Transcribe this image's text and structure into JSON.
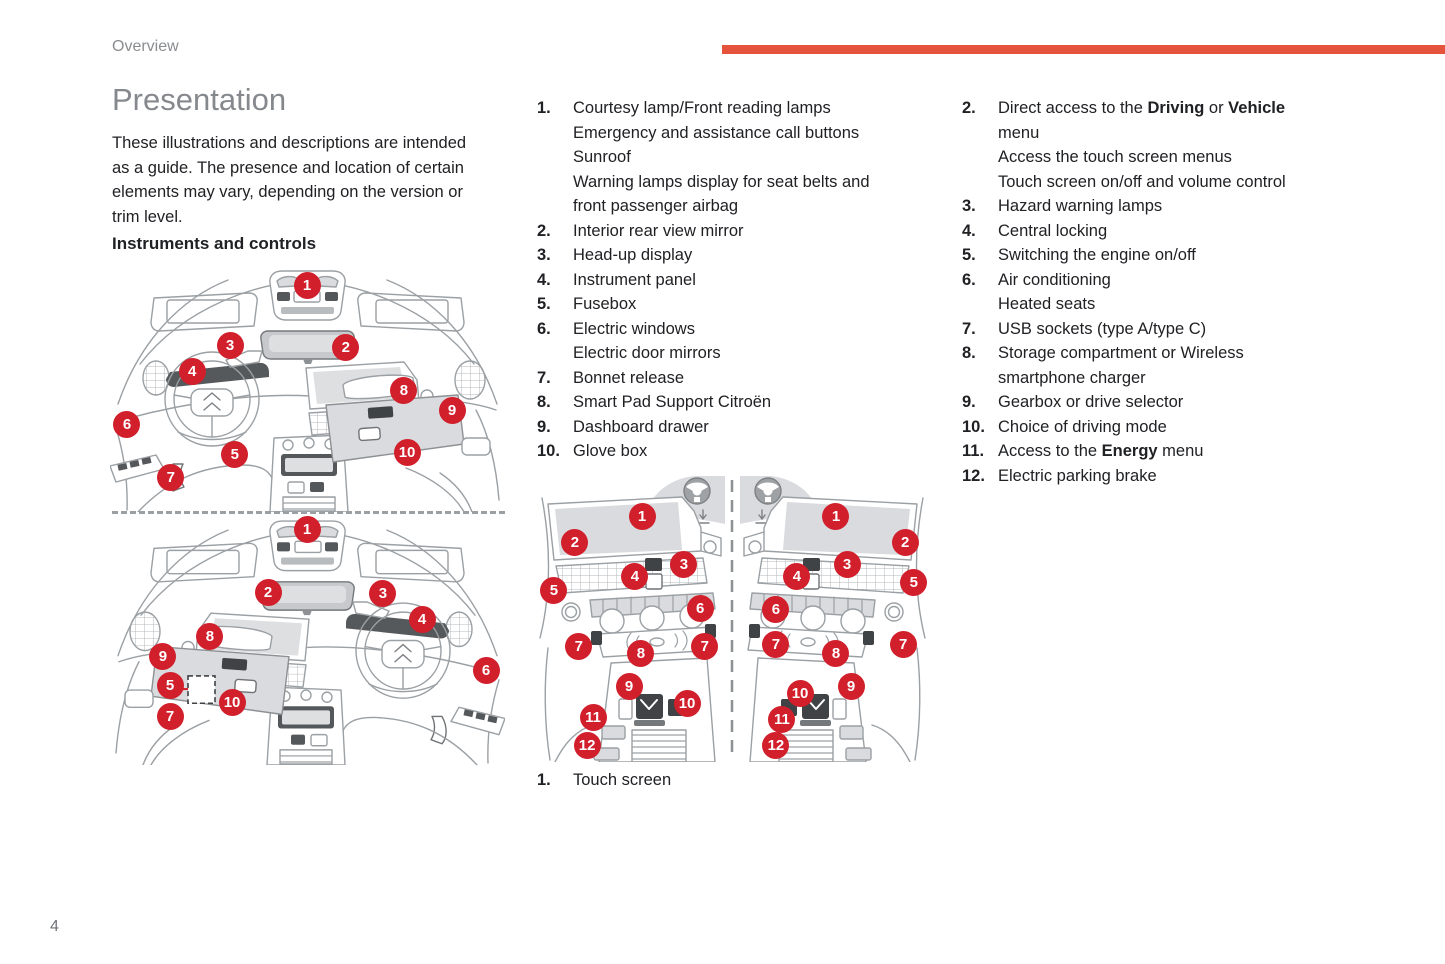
{
  "page": {
    "header": "Overview",
    "page_number": "4",
    "colors": {
      "accent_red": "#e6533c",
      "marker_red": "#d11f2b"
    }
  },
  "intro": {
    "title": "Presentation",
    "body_lines": [
      "These illustrations and descriptions are intended",
      "as a guide. The presence and location of certain",
      "elements may vary, depending on the version or",
      "trim level."
    ],
    "subheading": "Instruments and controls"
  },
  "lists": {
    "instruments": [
      {
        "n": "1.",
        "lines": [
          "Courtesy lamp/Front reading lamps",
          "Emergency and assistance call buttons",
          "Sunroof",
          "Warning lamps display for seat belts and",
          "front passenger airbag"
        ]
      },
      {
        "n": "2.",
        "lines": [
          "Interior rear view mirror"
        ]
      },
      {
        "n": "3.",
        "lines": [
          "Head-up display"
        ]
      },
      {
        "n": "4.",
        "lines": [
          "Instrument panel"
        ]
      },
      {
        "n": "5.",
        "lines": [
          "Fusebox"
        ]
      },
      {
        "n": "6.",
        "lines": [
          "Electric windows",
          "Electric door mirrors"
        ]
      },
      {
        "n": "7.",
        "lines": [
          "Bonnet release"
        ]
      },
      {
        "n": "8.",
        "lines": [
          "Smart Pad Support Citroën"
        ]
      },
      {
        "n": "9.",
        "lines": [
          "Dashboard drawer"
        ]
      },
      {
        "n": "10.",
        "lines": [
          "Glove box"
        ]
      }
    ],
    "console": [
      {
        "n": "2.",
        "lines": [
          [
            {
              "t": "Direct access to the "
            },
            {
              "t": "Driving",
              "b": true
            },
            {
              "t": " or "
            },
            {
              "t": "Vehicle",
              "b": true
            }
          ],
          "menu",
          "Access the touch screen menus",
          "Touch screen on/off and volume control"
        ]
      },
      {
        "n": "3.",
        "lines": [
          "Hazard warning lamps"
        ]
      },
      {
        "n": "4.",
        "lines": [
          "Central locking"
        ]
      },
      {
        "n": "5.",
        "lines": [
          "Switching the engine on/off"
        ]
      },
      {
        "n": "6.",
        "lines": [
          "Air conditioning",
          "Heated seats"
        ]
      },
      {
        "n": "7.",
        "lines": [
          "USB sockets (type A/type C)"
        ]
      },
      {
        "n": "8.",
        "lines": [
          "Storage compartment or Wireless",
          "smartphone charger"
        ]
      },
      {
        "n": "9.",
        "lines": [
          "Gearbox or drive selector"
        ]
      },
      {
        "n": "10.",
        "lines": [
          "Choice of driving mode"
        ]
      },
      {
        "n": "11.",
        "lines": [
          [
            {
              "t": "Access to the "
            },
            {
              "t": "Energy",
              "b": true
            },
            {
              "t": " menu"
            }
          ]
        ]
      },
      {
        "n": "12.",
        "lines": [
          "Electric parking brake"
        ]
      }
    ],
    "console_caption": [
      {
        "n": "1.",
        "lines": [
          "Touch screen"
        ]
      }
    ]
  },
  "diagrams": {
    "dashboard_lhd": {
      "markers": [
        {
          "n": "1",
          "x": 49.9,
          "y": 7.0
        },
        {
          "n": "2",
          "x": 59.7,
          "y": 32.4
        },
        {
          "n": "3",
          "x": 30.4,
          "y": 31.6
        },
        {
          "n": "4",
          "x": 20.8,
          "y": 42.6
        },
        {
          "n": "5",
          "x": 31.6,
          "y": 76.6
        },
        {
          "n": "6",
          "x": 4.3,
          "y": 64.3
        },
        {
          "n": "7",
          "x": 15.4,
          "y": 85.7
        },
        {
          "n": "8",
          "x": 74.4,
          "y": 50.0
        },
        {
          "n": "9",
          "x": 86.6,
          "y": 58.2
        },
        {
          "n": "10",
          "x": 75.2,
          "y": 75.8
        }
      ]
    },
    "dashboard_rhd": {
      "markers": [
        {
          "n": "1",
          "x": 49.9,
          "y": 4.5
        },
        {
          "n": "2",
          "x": 40.0,
          "y": 30.0
        },
        {
          "n": "3",
          "x": 69.1,
          "y": 30.4
        },
        {
          "n": "4",
          "x": 79.0,
          "y": 40.9
        },
        {
          "n": "5",
          "x": 15.2,
          "y": 68.0
        },
        {
          "n": "6",
          "x": 95.2,
          "y": 61.9
        },
        {
          "n": "7",
          "x": 15.2,
          "y": 80.2
        },
        {
          "n": "8",
          "x": 25.3,
          "y": 47.8
        },
        {
          "n": "9",
          "x": 13.4,
          "y": 55.9
        },
        {
          "n": "10",
          "x": 30.9,
          "y": 74.5
        }
      ]
    },
    "console": {
      "markers": [
        {
          "n": "1",
          "x": 27.1,
          "y": 15.8
        },
        {
          "n": "2",
          "x": 10.1,
          "y": 24.7
        },
        {
          "n": "3",
          "x": 37.7,
          "y": 32.2
        },
        {
          "n": "4",
          "x": 25.3,
          "y": 36.6
        },
        {
          "n": "5",
          "x": 4.8,
          "y": 41.1
        },
        {
          "n": "6",
          "x": 41.8,
          "y": 47.6
        },
        {
          "n": "7",
          "x": 11.1,
          "y": 60.6
        },
        {
          "n": "7",
          "x": 43.0,
          "y": 60.6
        },
        {
          "n": "8",
          "x": 26.8,
          "y": 62.7
        },
        {
          "n": "9",
          "x": 23.8,
          "y": 74.0
        },
        {
          "n": "10",
          "x": 38.5,
          "y": 80.1
        },
        {
          "n": "11",
          "x": 14.7,
          "y": 84.6
        },
        {
          "n": "12",
          "x": 13.2,
          "y": 94.2
        },
        {
          "n": "1",
          "x": 76.2,
          "y": 15.8
        },
        {
          "n": "2",
          "x": 93.7,
          "y": 24.7
        },
        {
          "n": "3",
          "x": 79.0,
          "y": 32.2
        },
        {
          "n": "4",
          "x": 66.3,
          "y": 36.6
        },
        {
          "n": "5",
          "x": 95.9,
          "y": 38.4
        },
        {
          "n": "6",
          "x": 61.0,
          "y": 47.9
        },
        {
          "n": "7",
          "x": 61.0,
          "y": 59.9
        },
        {
          "n": "7",
          "x": 93.2,
          "y": 59.6
        },
        {
          "n": "8",
          "x": 76.2,
          "y": 63.0
        },
        {
          "n": "9",
          "x": 80.0,
          "y": 74.0
        },
        {
          "n": "10",
          "x": 67.1,
          "y": 76.4
        },
        {
          "n": "11",
          "x": 62.5,
          "y": 85.3
        },
        {
          "n": "12",
          "x": 61.0,
          "y": 94.2
        }
      ]
    }
  }
}
